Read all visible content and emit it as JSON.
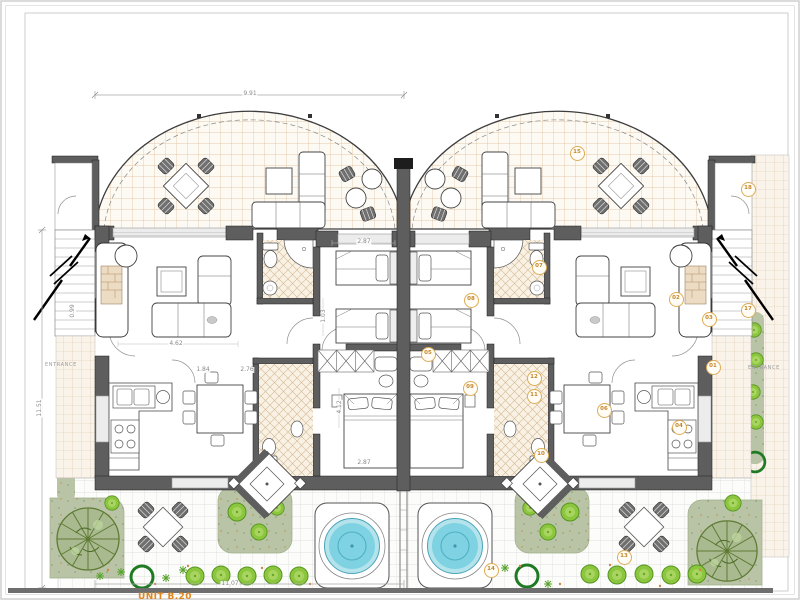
{
  "plan": {
    "unit_label": "UNIT B.20"
  },
  "entrance_label": "ENTRANCE",
  "badges": {
    "n01": "01",
    "n02": "02",
    "n03": "03",
    "n04": "04",
    "n05": "05",
    "n06": "06",
    "n07": "07",
    "n08": "08",
    "n09": "09",
    "n10": "10",
    "n11": "11",
    "n12": "12",
    "n13": "13",
    "n14": "14",
    "n15": "15",
    "n17": "17",
    "n18": "18"
  },
  "dims": {
    "overall_width": "9.91",
    "overall_depth": "11.51",
    "plot_width": "11.07",
    "living_width": "4.62",
    "hall_width": "1.84",
    "dining_width": "2.76",
    "twin_width": "2.87",
    "master_width": "2.87",
    "stair_width": "0.99",
    "closet_width": "1.03",
    "master_depth": "4.12"
  },
  "colors": {
    "room_badge": "#d9a441",
    "unit_label": "#e2861c",
    "wall": "#5e5e5e",
    "terrace_tile_line": "#ddbb96",
    "pool_water": "#7fd2e2",
    "shrub_green": "#8cc63f",
    "garden_bed": "#b9c4a6",
    "tree_olive": "#5e7a33"
  }
}
